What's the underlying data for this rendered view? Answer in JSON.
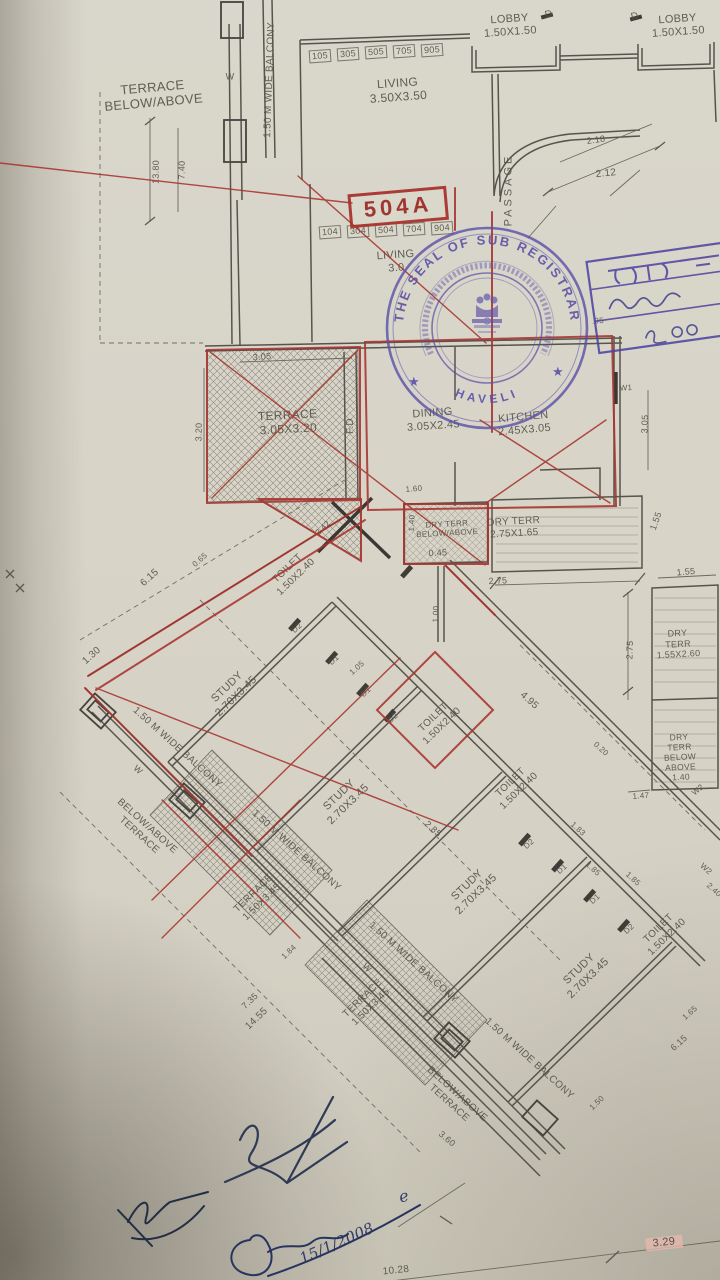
{
  "document": {
    "kind": "Photographed architectural floor plan page",
    "highlighted_unit": "504A"
  },
  "seal": {
    "ring_text": "THE SEAL OF SUB REGISTRAR",
    "inner_text_devanagari": "हवेली क.-११ चे सब रजिस्ट्रार",
    "bottom_text": "HAVELI",
    "star": "★",
    "color": "#584ea6"
  },
  "office_stamp": {
    "line1_devanagari": "हवल-",
    "note_devanagari": "२००",
    "color": "#4a41a0"
  },
  "labels": [
    {
      "n": "terrace-below-above-label",
      "t": "TERRACE\nBELOW/ABOVE",
      "x": 153,
      "y": 95,
      "r": -5,
      "s": 13
    },
    {
      "n": "balcony-label",
      "t": "1.50 M WIDE BALCONY",
      "x": 270,
      "y": 80,
      "r": -88,
      "s": 10
    },
    {
      "n": "dim",
      "t": "13.80",
      "x": 156,
      "y": 172,
      "r": -89,
      "s": 9
    },
    {
      "n": "dim",
      "t": "7.40",
      "x": 182,
      "y": 170,
      "r": -89,
      "s": 9
    },
    {
      "n": "room-label",
      "t": "LIVING\n3.50X3.50",
      "x": 398,
      "y": 90,
      "r": -4,
      "s": 12
    },
    {
      "n": "room-label",
      "t": "LOBBY\n1.50X1.50",
      "x": 510,
      "y": 26,
      "r": -4,
      "s": 11
    },
    {
      "n": "room-label",
      "t": "LOBBY\n1.50X1.50",
      "x": 678,
      "y": 26,
      "r": -4,
      "s": 11
    },
    {
      "n": "door-label",
      "t": "D",
      "x": 549,
      "y": 15,
      "r": -15,
      "s": 10
    },
    {
      "n": "door-label",
      "t": "D",
      "x": 635,
      "y": 17,
      "r": -15,
      "s": 10
    },
    {
      "n": "passage-label",
      "t": "PASSAGE",
      "x": 509,
      "y": 190,
      "r": -90,
      "s": 11,
      "ls": 3
    },
    {
      "n": "dim",
      "t": "2.18",
      "x": 596,
      "y": 140,
      "r": -8,
      "s": 9
    },
    {
      "n": "dim",
      "t": "2.12",
      "x": 606,
      "y": 174,
      "r": -6,
      "s": 10
    },
    {
      "n": "unit-number",
      "t": "105",
      "x": 320,
      "y": 56,
      "r": -4,
      "s": 9,
      "c": "box"
    },
    {
      "n": "unit-number",
      "t": "305",
      "x": 348,
      "y": 54,
      "r": -4,
      "s": 9,
      "c": "box"
    },
    {
      "n": "unit-number",
      "t": "505",
      "x": 376,
      "y": 52,
      "r": -4,
      "s": 9,
      "c": "box"
    },
    {
      "n": "unit-number",
      "t": "705",
      "x": 404,
      "y": 51,
      "r": -4,
      "s": 9,
      "c": "box"
    },
    {
      "n": "unit-number",
      "t": "905",
      "x": 432,
      "y": 50,
      "r": -4,
      "s": 9,
      "c": "box"
    },
    {
      "n": "unit-number",
      "t": "104",
      "x": 330,
      "y": 232,
      "r": -4,
      "s": 9,
      "c": "box"
    },
    {
      "n": "unit-number",
      "t": "304",
      "x": 358,
      "y": 231,
      "r": -4,
      "s": 9,
      "c": "box"
    },
    {
      "n": "unit-number",
      "t": "504",
      "x": 386,
      "y": 230,
      "r": -4,
      "s": 9,
      "c": "box"
    },
    {
      "n": "unit-number",
      "t": "704",
      "x": 414,
      "y": 229,
      "r": -4,
      "s": 9,
      "c": "box"
    },
    {
      "n": "unit-number",
      "t": "904",
      "x": 442,
      "y": 228,
      "r": -4,
      "s": 9,
      "c": "box"
    },
    {
      "n": "unit-highlight",
      "t": "504A",
      "x": 398,
      "y": 207,
      "r": -5,
      "s": 22,
      "c": "redbox"
    },
    {
      "n": "room-label",
      "t": "LIVING\n3.0",
      "x": 396,
      "y": 262,
      "r": -4,
      "s": 11
    },
    {
      "n": "room-label",
      "t": "TERRACE\n3.05X3.20",
      "x": 288,
      "y": 422,
      "r": -3,
      "s": 12
    },
    {
      "n": "dim",
      "t": "3.05",
      "x": 262,
      "y": 357,
      "r": -4,
      "s": 9
    },
    {
      "n": "dim",
      "t": "3.20",
      "x": 199,
      "y": 432,
      "r": -89,
      "s": 9
    },
    {
      "n": "fd-label",
      "t": "F.D",
      "x": 351,
      "y": 426,
      "r": -90,
      "s": 10
    },
    {
      "n": "room-label",
      "t": "DINING\n3.05X2.45",
      "x": 433,
      "y": 420,
      "r": -4,
      "s": 11
    },
    {
      "n": "room-label",
      "t": "KITCHEN\n2.45X3.05",
      "x": 524,
      "y": 424,
      "r": -5,
      "s": 11
    },
    {
      "n": "window-label",
      "t": "W1",
      "x": 626,
      "y": 388,
      "r": -3,
      "s": 8
    },
    {
      "n": "dim",
      "t": "3.05",
      "x": 645,
      "y": 424,
      "r": -88,
      "s": 9
    },
    {
      "n": "dim",
      "t": ".95",
      "x": 598,
      "y": 321,
      "r": -4,
      "s": 8
    },
    {
      "n": "dim",
      "t": "1.60",
      "x": 414,
      "y": 489,
      "r": -4,
      "s": 8
    },
    {
      "n": "room-label",
      "t": "DRY TERR\nBELOW/ABOVE",
      "x": 447,
      "y": 529,
      "r": -3,
      "s": 8
    },
    {
      "n": "dim",
      "t": "1.40",
      "x": 412,
      "y": 523,
      "r": -88,
      "s": 8
    },
    {
      "n": "dim",
      "t": "0.45",
      "x": 438,
      "y": 553,
      "r": -3,
      "s": 9
    },
    {
      "n": "room-label",
      "t": "DRY TERR\n2.75X1.65",
      "x": 514,
      "y": 528,
      "r": -3,
      "s": 10
    },
    {
      "n": "dim",
      "t": "2.75",
      "x": 498,
      "y": 581,
      "r": -3,
      "s": 9
    },
    {
      "n": "dim",
      "t": "1.55",
      "x": 656,
      "y": 521,
      "r": -70,
      "s": 9
    },
    {
      "n": "dim",
      "t": "1.00",
      "x": 436,
      "y": 614,
      "r": -88,
      "s": 8
    },
    {
      "n": "dim",
      "t": "1.55",
      "x": 686,
      "y": 572,
      "r": -5,
      "s": 9
    },
    {
      "n": "dim",
      "t": "2.75",
      "x": 630,
      "y": 650,
      "r": -88,
      "s": 9
    },
    {
      "n": "room-label",
      "t": "DRY TERR\n1.55X2.60",
      "x": 678,
      "y": 644,
      "r": -3,
      "s": 9
    },
    {
      "n": "room-label",
      "t": "DRY TERR\nBELOW\nABOVE\n1.40",
      "x": 680,
      "y": 757,
      "r": -3,
      "s": 8.5
    },
    {
      "n": "dim",
      "t": "1.47",
      "x": 641,
      "y": 796,
      "r": -4,
      "s": 8
    },
    {
      "n": "window-label",
      "t": "W2",
      "x": 698,
      "y": 790,
      "r": -40,
      "s": 8
    },
    {
      "n": "dim",
      "t": "6.15",
      "x": 150,
      "y": 578,
      "r": -42,
      "s": 10
    },
    {
      "n": "dim",
      "t": "0.65",
      "x": 200,
      "y": 560,
      "r": -42,
      "s": 8
    },
    {
      "n": "dim",
      "t": "1.30",
      "x": 92,
      "y": 656,
      "r": -42,
      "s": 10
    },
    {
      "n": "room-label",
      "t": "TOILET\n1.50X2.40",
      "x": 292,
      "y": 573,
      "r": -44,
      "s": 10
    },
    {
      "n": "dim",
      "t": "2.42",
      "x": 323,
      "y": 528,
      "r": -44,
      "s": 8
    },
    {
      "n": "door-label",
      "t": "D2",
      "x": 297,
      "y": 628,
      "r": -42,
      "s": 8
    },
    {
      "n": "door-label",
      "t": "D1",
      "x": 334,
      "y": 660,
      "r": -42,
      "s": 8
    },
    {
      "n": "dim",
      "t": "1.05",
      "x": 357,
      "y": 668,
      "r": -42,
      "s": 8
    },
    {
      "n": "door-label",
      "t": "D1",
      "x": 366,
      "y": 692,
      "r": -42,
      "s": 8
    },
    {
      "n": "door-label",
      "t": "D2",
      "x": 393,
      "y": 718,
      "r": -42,
      "s": 8
    },
    {
      "n": "room-label",
      "t": "STUDY\n2.70X3.45",
      "x": 232,
      "y": 692,
      "r": -44,
      "s": 11
    },
    {
      "n": "room-label",
      "t": "STUDY\n2.70X3.45",
      "x": 344,
      "y": 800,
      "r": -44,
      "s": 11
    },
    {
      "n": "room-label",
      "t": "STUDY\n2.70X3.45",
      "x": 472,
      "y": 890,
      "r": -44,
      "s": 11
    },
    {
      "n": "room-label",
      "t": "STUDY\n2.70X3.45",
      "x": 584,
      "y": 974,
      "r": -44,
      "s": 11
    },
    {
      "n": "room-label",
      "t": "TOILET\n1.50X2.40",
      "x": 438,
      "y": 722,
      "r": -44,
      "s": 10
    },
    {
      "n": "room-label",
      "t": "TOILET\n1.50X2.40",
      "x": 515,
      "y": 787,
      "r": -44,
      "s": 10
    },
    {
      "n": "room-label",
      "t": "TOILET\n1.50X2.40",
      "x": 663,
      "y": 933,
      "r": -44,
      "s": 10
    },
    {
      "n": "balcony-label",
      "t": "1.50 M WIDE BALCONY",
      "x": 177,
      "y": 748,
      "r": 42,
      "s": 10
    },
    {
      "n": "balcony-label",
      "t": "1.50 M WIDE BALCONY",
      "x": 296,
      "y": 851,
      "r": 42,
      "s": 10
    },
    {
      "n": "balcony-label",
      "t": "1.50 M WIDE BALCONY",
      "x": 413,
      "y": 963,
      "r": 42,
      "s": 10
    },
    {
      "n": "balcony-label",
      "t": "1.50 M WIDE BALCONY",
      "x": 529,
      "y": 1059,
      "r": 42,
      "s": 10
    },
    {
      "n": "terrace-label",
      "t": "BELOW/ABOVE\nTERRACE",
      "x": 143,
      "y": 831,
      "r": 42,
      "s": 10
    },
    {
      "n": "terrace-label",
      "t": "BELOW/ABOVE\nTERRACE",
      "x": 453,
      "y": 1099,
      "r": 42,
      "s": 10
    },
    {
      "n": "room-label",
      "t": "TERRACE\n1.50X3.45",
      "x": 258,
      "y": 898,
      "r": -44,
      "s": 10
    },
    {
      "n": "room-label",
      "t": "TERRACE\n1.50X3.45",
      "x": 367,
      "y": 1003,
      "r": -44,
      "s": 10
    },
    {
      "n": "window-label",
      "t": "W",
      "x": 138,
      "y": 770,
      "r": 42,
      "s": 9
    },
    {
      "n": "window-label",
      "t": "W",
      "x": 367,
      "y": 968,
      "r": 42,
      "s": 9
    },
    {
      "n": "window-label",
      "t": "W",
      "x": 230,
      "y": 77,
      "r": 0,
      "s": 9
    },
    {
      "n": "dim",
      "t": "4.95",
      "x": 529,
      "y": 701,
      "r": 42,
      "s": 10
    },
    {
      "n": "dim",
      "t": "2.85",
      "x": 433,
      "y": 829,
      "r": 42,
      "s": 9
    },
    {
      "n": "dim",
      "t": "1.83",
      "x": 578,
      "y": 829,
      "r": 42,
      "s": 8
    },
    {
      "n": "dim",
      "t": "1.85",
      "x": 593,
      "y": 869,
      "r": 42,
      "s": 8
    },
    {
      "n": "dim",
      "t": "1.85",
      "x": 633,
      "y": 879,
      "r": 42,
      "s": 8
    },
    {
      "n": "dim",
      "t": "0.20",
      "x": 601,
      "y": 749,
      "r": 42,
      "s": 8
    },
    {
      "n": "door-label",
      "t": "D2",
      "x": 529,
      "y": 844,
      "r": -42,
      "s": 8
    },
    {
      "n": "door-label",
      "t": "D1",
      "x": 562,
      "y": 869,
      "r": -42,
      "s": 8
    },
    {
      "n": "door-label",
      "t": "D1",
      "x": 595,
      "y": 899,
      "r": -42,
      "s": 8
    },
    {
      "n": "door-label",
      "t": "D2",
      "x": 629,
      "y": 929,
      "r": -42,
      "s": 8
    },
    {
      "n": "window-label",
      "t": "W2",
      "x": 706,
      "y": 869,
      "r": 42,
      "s": 8
    },
    {
      "n": "dim",
      "t": "2.40",
      "x": 714,
      "y": 890,
      "r": 42,
      "s": 8
    },
    {
      "n": "dim",
      "t": "1.65",
      "x": 690,
      "y": 1013,
      "r": -42,
      "s": 8
    },
    {
      "n": "dim",
      "t": "6.15",
      "x": 679,
      "y": 1043,
      "r": -42,
      "s": 9
    },
    {
      "n": "dim",
      "t": "7.35",
      "x": 250,
      "y": 1001,
      "r": -44,
      "s": 9
    },
    {
      "n": "dim",
      "t": "14.55",
      "x": 257,
      "y": 1019,
      "r": -44,
      "s": 10
    },
    {
      "n": "dim",
      "t": "1.84",
      "x": 289,
      "y": 952,
      "r": -44,
      "s": 8
    },
    {
      "n": "dim",
      "t": "3.60",
      "x": 447,
      "y": 1139,
      "r": 40,
      "s": 9
    },
    {
      "n": "dim",
      "t": "1.50",
      "x": 597,
      "y": 1103,
      "r": -44,
      "s": 8
    },
    {
      "n": "dim",
      "t": "3.29",
      "x": 664,
      "y": 1243,
      "r": -6,
      "s": 11,
      "c": "hl"
    },
    {
      "n": "dim",
      "t": "10.28",
      "x": 396,
      "y": 1271,
      "r": -6,
      "s": 10
    },
    {
      "n": "handwriting",
      "t": "e",
      "x": 404,
      "y": 1197,
      "r": -15,
      "s": 16,
      "c": "hand"
    },
    {
      "n": "handwriting-date",
      "t": "15/1/2008",
      "x": 337,
      "y": 1244,
      "r": -24,
      "s": 15,
      "c": "hand"
    }
  ]
}
